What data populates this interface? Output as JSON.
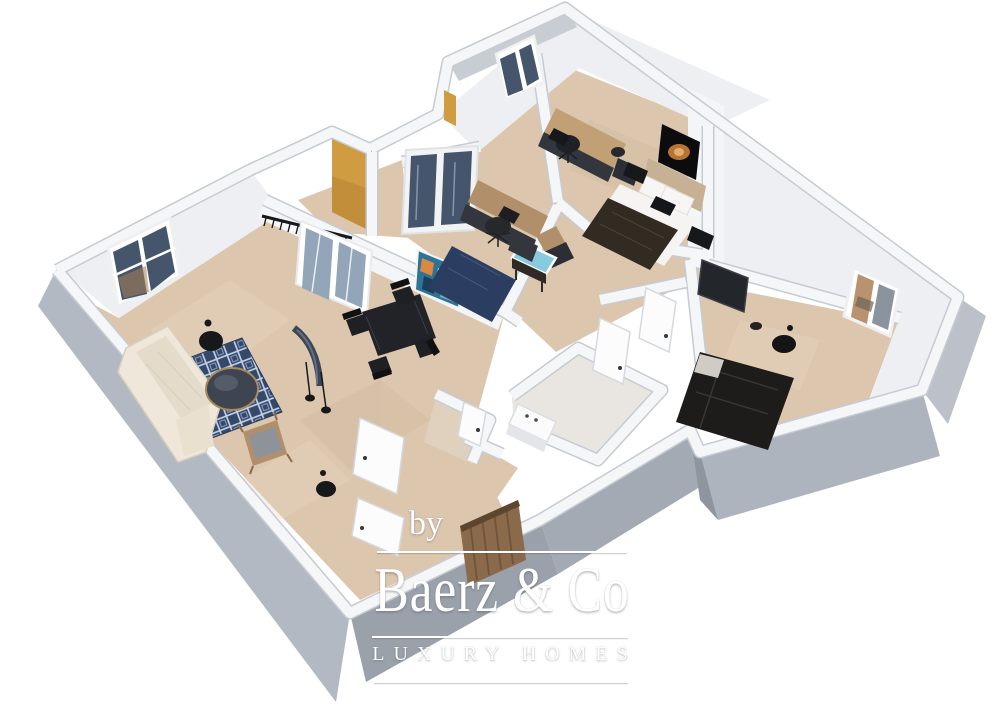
{
  "watermark": {
    "prefix": "by",
    "brand": "Baerz & Co",
    "tagline": "LUXURY HOMES",
    "color": "#ffffff"
  },
  "colors": {
    "background": "#ffffff",
    "floor": "#dcc6ae",
    "floor_light": "#e6d4c0",
    "bath_floor": "#e9e6e2",
    "wc_floor": "#e0d0be",
    "outer_wall_left": "#b3b9c2",
    "outer_wall_front": "#9ba1aa",
    "outer_wall_front2": "#a4aab3",
    "outer_wall_front3": "#aeb4bd",
    "outer_wall_right": "#bcc1c9",
    "outer_wall_top": "#c8cdd4",
    "inner_wall": "#edeff2",
    "wall_top": "#f4f6f8",
    "wall_edge": "#c6cbd2",
    "accent_orange": "#cf9c42",
    "rug_living": "#33486b",
    "rug_office": "#2c3d62",
    "sofa": "#efe7d9",
    "wood": "#b28f6b",
    "wood_light": "#c2a076",
    "dark_furniture": "#33363c",
    "black_furniture": "#212329",
    "bed1_blanket": "#322b22",
    "bed2_blanket": "#1d1c1a",
    "headboard": "#c6b195",
    "linen": "#f5f4f2",
    "glass_dark": "#45566c",
    "glass_light": "#93a5b8",
    "aquarium": "#86ccdc",
    "painting_teal": "#2e7295",
    "painting_orange": "#d98a3f",
    "art_orange": "#c87f36",
    "entry_door_wood": "#8a6a4a"
  }
}
